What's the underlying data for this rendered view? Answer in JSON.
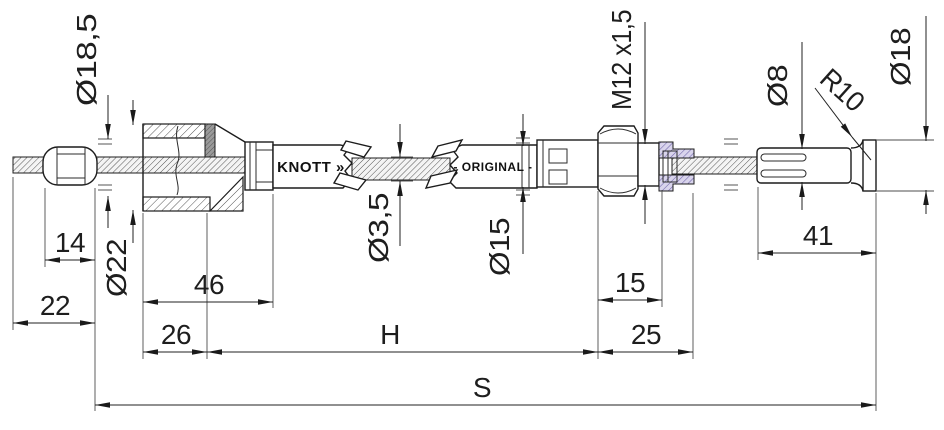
{
  "labels": {
    "brand": "KNOTT »",
    "original": "- ORIGINAL -"
  },
  "dims": {
    "dia18_5": "Ø18,5",
    "dia22": "Ø22",
    "dia3_5": "Ø3,5",
    "dia15": "Ø15",
    "thread": "M12 x1,5",
    "dia8": "Ø8",
    "r10": "R10",
    "dia18": "Ø18",
    "l14": "14",
    "l22": "22",
    "l46": "46",
    "l26": "26",
    "l15": "15",
    "l25": "25",
    "l41": "41",
    "h": "H",
    "s": "S"
  },
  "colors": {
    "line": "#1e1e1e",
    "hatch_purple": "#7b6fad",
    "band_dark": "#8f8f8f"
  }
}
